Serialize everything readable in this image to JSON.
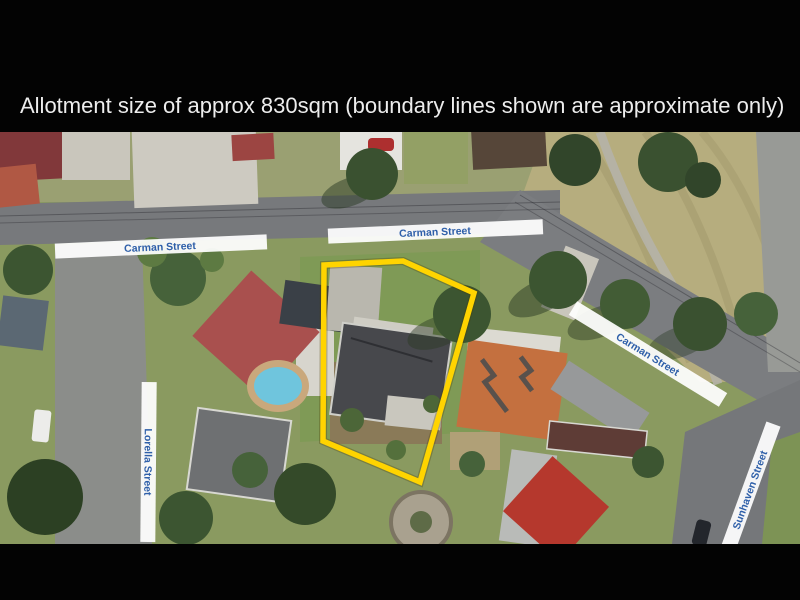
{
  "banner": {
    "caption": "Allotment size of approx 830sqm (boundary lines shown are approximate only)",
    "background": "#030303",
    "text_color": "#ededed"
  },
  "map": {
    "street_labels": [
      {
        "id": "carman-west",
        "text": "Carman Street"
      },
      {
        "id": "carman-center",
        "text": "Carman Street"
      },
      {
        "id": "carman-east",
        "text": "Carman Street"
      },
      {
        "id": "lorella",
        "text": "Lorella Street"
      },
      {
        "id": "sunhaven",
        "text": "Sunhaven Street"
      }
    ],
    "label_band_color": "#ffffff",
    "label_text_color": "#2e5fa9",
    "boundary": {
      "color": "#ffd400",
      "stroke_width": 5.5,
      "points": "324,133 403,129 474,161 420,350 323,309"
    },
    "allotment_size_sqm": "830"
  }
}
